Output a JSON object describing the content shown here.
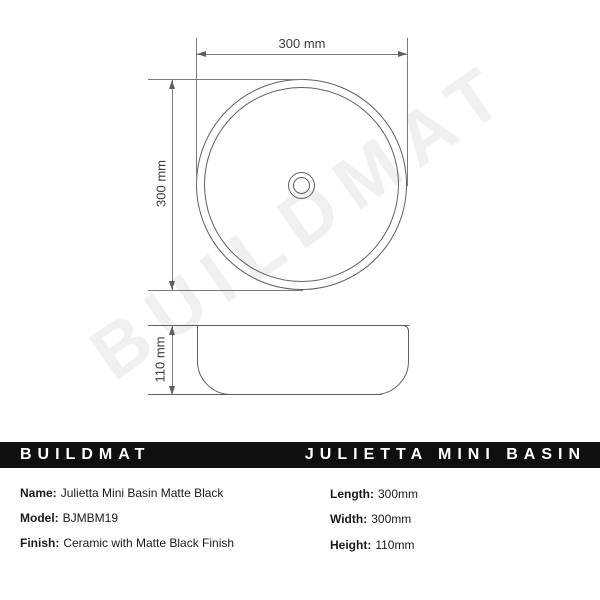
{
  "watermark_text": "BUILDMAT",
  "drawing": {
    "top_view": {
      "width_label": "300 mm",
      "height_label": "300 mm"
    },
    "side_view": {
      "height_label": "110 mm"
    }
  },
  "banner": {
    "brand": "BUILDMAT",
    "product_name": "JULIETTA MINI BASIN",
    "background_color": "#0f0f0f",
    "text_color": "#ffffff"
  },
  "specs": {
    "left": [
      {
        "label": "Name:",
        "value": "Julietta Mini Basin Matte Black"
      },
      {
        "label": "Model:",
        "value": "BJMBM19"
      },
      {
        "label": "Finish:",
        "value": "Ceramic with Matte Black Finish"
      }
    ],
    "right": [
      {
        "label": "Length:",
        "value": "300mm"
      },
      {
        "label": "Width:",
        "value": "300mm"
      },
      {
        "label": "Height:",
        "value": "110mm"
      }
    ]
  },
  "colors": {
    "drawing_line": "#5f5f5f",
    "dimension_text": "#3d3d3d",
    "watermark": "#f1f0ef",
    "background": "#ffffff"
  }
}
